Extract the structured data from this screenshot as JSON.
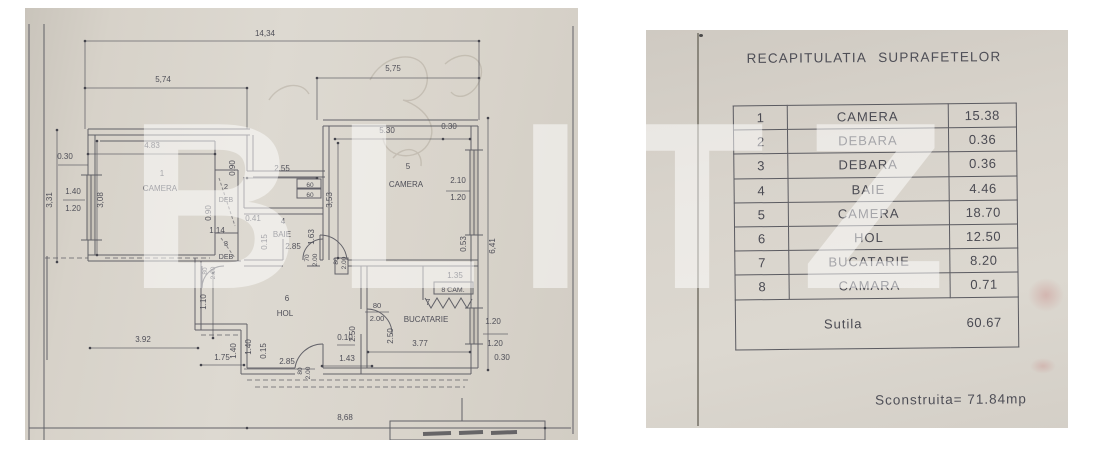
{
  "watermark": {
    "text": "BLITZ"
  },
  "floorplan": {
    "labels": [
      {
        "t": "14,34",
        "x": 240,
        "y": 28
      },
      {
        "t": "5,74",
        "x": 138,
        "y": 74
      },
      {
        "t": "5,75",
        "x": 368,
        "y": 63
      },
      {
        "t": "0.30",
        "x": 40,
        "y": 151
      },
      {
        "t": "1.40",
        "x": 48,
        "y": 186
      },
      {
        "t": "1.20",
        "x": 48,
        "y": 203
      },
      {
        "t": "3,31",
        "x": 27,
        "y": 192,
        "r": -90
      },
      {
        "t": "3,08",
        "x": 78,
        "y": 192,
        "r": -90
      },
      {
        "t": "4.83",
        "x": 127,
        "y": 140
      },
      {
        "t": "1",
        "x": 137,
        "y": 168
      },
      {
        "t": "CAMERA",
        "x": 135,
        "y": 183
      },
      {
        "t": "0.90",
        "x": 210,
        "y": 160,
        "r": -90
      },
      {
        "t": "2",
        "x": 201,
        "y": 181,
        "s": 7.5
      },
      {
        "t": "DEB",
        "x": 201,
        "y": 194,
        "s": 7
      },
      {
        "t": "0.90",
        "x": 186,
        "y": 205,
        "r": -90
      },
      {
        "t": "1.14",
        "x": 192,
        "y": 225
      },
      {
        "t": "0.41",
        "x": 228,
        "y": 213
      },
      {
        "t": "3",
        "x": 201,
        "y": 238,
        "s": 7.5
      },
      {
        "t": "DEB",
        "x": 201,
        "y": 251,
        "s": 7
      },
      {
        "t": "4",
        "x": 258,
        "y": 216
      },
      {
        "t": "BAIE",
        "x": 257,
        "y": 229
      },
      {
        "t": "0.15",
        "x": 242,
        "y": 234,
        "r": -90
      },
      {
        "t": "2.85",
        "x": 268,
        "y": 241
      },
      {
        "t": "1.63",
        "x": 289,
        "y": 229,
        "r": -90
      },
      {
        "t": "2.55",
        "x": 257,
        "y": 163
      },
      {
        "t": "60",
        "x": 285,
        "y": 179,
        "s": 6.5
      },
      {
        "t": "60",
        "x": 285,
        "y": 189,
        "s": 6.5
      },
      {
        "t": "3,53",
        "x": 307,
        "y": 192,
        "r": -90
      },
      {
        "t": "5.30",
        "x": 362,
        "y": 125
      },
      {
        "t": "0.30",
        "x": 424,
        "y": 121
      },
      {
        "t": "5",
        "x": 383,
        "y": 161
      },
      {
        "t": "CAMERA",
        "x": 381,
        "y": 179
      },
      {
        "t": "2.10",
        "x": 433,
        "y": 175
      },
      {
        "t": "1.20",
        "x": 433,
        "y": 192
      },
      {
        "t": "0.53",
        "x": 441,
        "y": 236,
        "r": -90
      },
      {
        "t": "6,41",
        "x": 470,
        "y": 238,
        "r": -90
      },
      {
        "t": "80",
        "x": 182,
        "y": 263,
        "r": -90,
        "s": 6.5
      },
      {
        "t": "2.00",
        "x": 190,
        "y": 265,
        "r": -90,
        "s": 6.5
      },
      {
        "t": "70",
        "x": 284,
        "y": 250,
        "r": -90,
        "s": 6.5
      },
      {
        "t": "2.00",
        "x": 292,
        "y": 252,
        "r": -90,
        "s": 6.5
      },
      {
        "t": "80",
        "x": 313,
        "y": 253,
        "r": -90,
        "s": 6.5
      },
      {
        "t": "2.00",
        "x": 321,
        "y": 255,
        "r": -90,
        "s": 6.5
      },
      {
        "t": "6",
        "x": 262,
        "y": 293
      },
      {
        "t": "HOL",
        "x": 260,
        "y": 308
      },
      {
        "t": "1.10",
        "x": 181,
        "y": 294,
        "r": -90
      },
      {
        "t": "80",
        "x": 352,
        "y": 300,
        "s": 7.5
      },
      {
        "t": "2.00",
        "x": 352,
        "y": 313,
        "s": 7.5
      },
      {
        "t": "7",
        "x": 403,
        "y": 297
      },
      {
        "t": "BUCATARIE",
        "x": 401,
        "y": 314
      },
      {
        "t": "1.35",
        "x": 430,
        "y": 270
      },
      {
        "t": "8 CAM.",
        "x": 428,
        "y": 284,
        "s": 7
      },
      {
        "t": "2.50",
        "x": 330,
        "y": 326,
        "r": -90
      },
      {
        "t": "2.50",
        "x": 368,
        "y": 328,
        "r": -90
      },
      {
        "t": "0.10",
        "x": 320,
        "y": 332
      },
      {
        "t": "1.43",
        "x": 322,
        "y": 353
      },
      {
        "t": "3.77",
        "x": 395,
        "y": 338
      },
      {
        "t": "1.20",
        "x": 468,
        "y": 316
      },
      {
        "t": "1.20",
        "x": 470,
        "y": 338
      },
      {
        "t": "0.30",
        "x": 477,
        "y": 352
      },
      {
        "t": "3.92",
        "x": 118,
        "y": 334
      },
      {
        "t": "1.75",
        "x": 197,
        "y": 352
      },
      {
        "t": "1.40",
        "x": 211,
        "y": 343,
        "r": -90
      },
      {
        "t": "1.40",
        "x": 226,
        "y": 339,
        "r": -90
      },
      {
        "t": "0.15",
        "x": 241,
        "y": 343,
        "r": -90
      },
      {
        "t": "2.85",
        "x": 262,
        "y": 356
      },
      {
        "t": "80",
        "x": 277,
        "y": 363,
        "r": -90,
        "s": 6.5
      },
      {
        "t": "2.00",
        "x": 285,
        "y": 365,
        "r": -90,
        "s": 6.5
      },
      {
        "t": "8,68",
        "x": 320,
        "y": 412
      }
    ]
  },
  "area_table": {
    "title": "RECAPITULATIA SUPRAFETELOR",
    "rows": [
      [
        "1",
        "CAMERA",
        "15.38"
      ],
      [
        "2",
        "DEBARA",
        "0.36"
      ],
      [
        "3",
        "DEBARA",
        "0.36"
      ],
      [
        "4",
        "BAIE",
        "4.46"
      ],
      [
        "5",
        "CAMERA",
        "18.70"
      ],
      [
        "6",
        "HOL",
        "12.50"
      ],
      [
        "7",
        "BUCATARIE",
        "8.20"
      ],
      [
        "8",
        "CAMARA",
        "0.71"
      ]
    ],
    "total_label": "Sutila",
    "total_value": "60.67",
    "footer": "Sconstruita= 71.84mp"
  }
}
